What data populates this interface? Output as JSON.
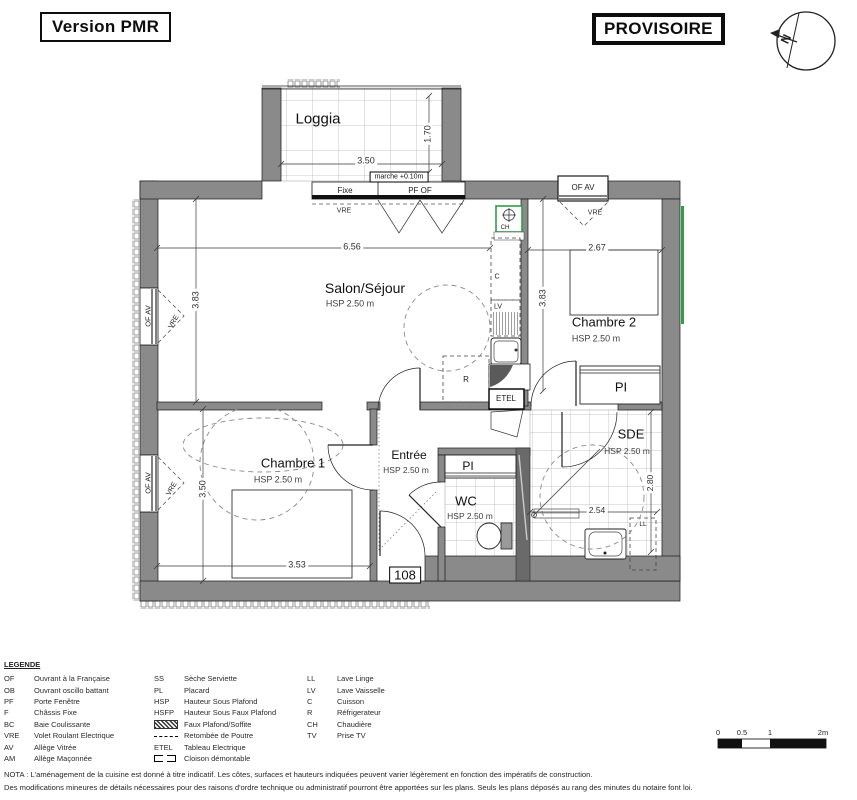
{
  "header": {
    "version_label": "Version PMR",
    "status_label": "PROVISOIRE"
  },
  "colors": {
    "accent_green": "#2f9e44",
    "wall_gray": "#8a8a8a"
  },
  "plan_labels": [
    {
      "name": "room-label-loggia",
      "text": "Loggia",
      "x": 318,
      "y": 119,
      "size": 15,
      "style": "room"
    },
    {
      "name": "dim-loggia-width",
      "text": "3.50",
      "x": 366,
      "y": 161,
      "size": 9,
      "style": "dim"
    },
    {
      "name": "dim-loggia-depth",
      "text": "1.70",
      "x": 428,
      "y": 134,
      "size": 9,
      "rot": -90,
      "style": "dim"
    },
    {
      "name": "label-marche",
      "text": "marche +0.10m",
      "x": 399,
      "y": 177,
      "size": 7,
      "style": "box"
    },
    {
      "name": "label-fixe",
      "text": "Fixe",
      "x": 345,
      "y": 191,
      "size": 8,
      "style": "tiny"
    },
    {
      "name": "label-pf-of",
      "text": "PF OF",
      "x": 420,
      "y": 191,
      "size": 8,
      "style": "tiny"
    },
    {
      "name": "label-vre-loggia",
      "text": "VRE",
      "x": 344,
      "y": 211,
      "size": 7,
      "style": "dim"
    },
    {
      "name": "label-of-av-top",
      "text": "OF AV",
      "x": 583,
      "y": 188,
      "size": 8,
      "style": "tiny"
    },
    {
      "name": "label-vre-top",
      "text": "VRE",
      "x": 595,
      "y": 213,
      "size": 7,
      "style": "dim"
    },
    {
      "name": "room-label-salon",
      "text": "Salon/Séjour",
      "x": 365,
      "y": 288,
      "size": 14,
      "style": "room"
    },
    {
      "name": "label-salon-hsp",
      "text": "HSP 2.50 m",
      "x": 350,
      "y": 304,
      "size": 9,
      "style": "hsp"
    },
    {
      "name": "dim-salon-width",
      "text": "6.56",
      "x": 352,
      "y": 247,
      "size": 9,
      "style": "dim"
    },
    {
      "name": "dim-salon-height",
      "text": "3.83",
      "x": 196,
      "y": 300,
      "size": 9,
      "rot": -90,
      "style": "dim"
    },
    {
      "name": "label-of-av-left-1",
      "text": "OF AV",
      "x": 148,
      "y": 316,
      "size": 7.5,
      "rot": -90,
      "style": "tiny"
    },
    {
      "name": "label-vre-left-1",
      "text": "VRE",
      "x": 174,
      "y": 322,
      "size": 7,
      "rot": -60,
      "style": "tiny"
    },
    {
      "name": "room-label-chambre2",
      "text": "Chambre 2",
      "x": 604,
      "y": 322,
      "size": 13,
      "style": "room"
    },
    {
      "name": "label-chambre2-hsp",
      "text": "HSP 2.50 m",
      "x": 596,
      "y": 339,
      "size": 9,
      "style": "hsp"
    },
    {
      "name": "dim-chambre2-width",
      "text": "2.67",
      "x": 597,
      "y": 248,
      "size": 9,
      "style": "dim"
    },
    {
      "name": "dim-chambre2-height",
      "text": "3.83",
      "x": 543,
      "y": 298,
      "size": 9,
      "rot": -90,
      "style": "dim"
    },
    {
      "name": "label-pi-chambre2",
      "text": "PI",
      "x": 621,
      "y": 387,
      "size": 13,
      "style": "room"
    },
    {
      "name": "room-label-sde",
      "text": "SDE",
      "x": 631,
      "y": 434,
      "size": 13,
      "style": "room"
    },
    {
      "name": "label-sde-hsp",
      "text": "HSP 2.50 m",
      "x": 627,
      "y": 451,
      "size": 8.5,
      "style": "hsp"
    },
    {
      "name": "dim-sde-width",
      "text": "2.54",
      "x": 597,
      "y": 510,
      "size": 8.5,
      "style": "dim"
    },
    {
      "name": "dim-sde-height",
      "text": "2.80",
      "x": 650,
      "y": 483,
      "size": 8.5,
      "rot": -90,
      "style": "dim"
    },
    {
      "name": "label-ll",
      "text": "LL",
      "x": 643,
      "y": 525,
      "size": 6.5,
      "style": "tiny"
    },
    {
      "name": "room-label-chambre1",
      "text": "Chambre 1",
      "x": 293,
      "y": 463,
      "size": 13,
      "style": "room"
    },
    {
      "name": "label-chambre1-hsp",
      "text": "HSP 2.50 m",
      "x": 278,
      "y": 480,
      "size": 9,
      "style": "hsp"
    },
    {
      "name": "dim-chambre1-height",
      "text": "3.50",
      "x": 203,
      "y": 489,
      "size": 9,
      "rot": -90,
      "style": "dim"
    },
    {
      "name": "dim-chambre1-width",
      "text": "3.53",
      "x": 297,
      "y": 565,
      "size": 9,
      "style": "dim"
    },
    {
      "name": "label-of-av-left-2",
      "text": "OF AV",
      "x": 148,
      "y": 483,
      "size": 7.5,
      "rot": -90,
      "style": "tiny"
    },
    {
      "name": "label-vre-left-2",
      "text": "VRE",
      "x": 172,
      "y": 489,
      "size": 7,
      "rot": -60,
      "style": "tiny"
    },
    {
      "name": "room-label-entree",
      "text": "Entrée",
      "x": 409,
      "y": 455,
      "size": 12,
      "style": "room"
    },
    {
      "name": "label-entree-hsp",
      "text": "HSP 2.50 m",
      "x": 406,
      "y": 470,
      "size": 8.5,
      "style": "hsp"
    },
    {
      "name": "label-pi-wc",
      "text": "PI",
      "x": 468,
      "y": 466,
      "size": 12,
      "style": "room"
    },
    {
      "name": "room-label-wc",
      "text": "WC",
      "x": 466,
      "y": 501,
      "size": 13,
      "style": "room"
    },
    {
      "name": "label-wc-hsp",
      "text": "HSP 2.50 m",
      "x": 470,
      "y": 516,
      "size": 8.5,
      "style": "hsp"
    },
    {
      "name": "label-etel",
      "text": "ETEL",
      "x": 506,
      "y": 399,
      "size": 8,
      "style": "tiny"
    },
    {
      "name": "label-ch",
      "text": "CH",
      "x": 505,
      "y": 228,
      "size": 6,
      "style": "tiny"
    },
    {
      "name": "label-c",
      "text": "C",
      "x": 497,
      "y": 277,
      "size": 7,
      "style": "tiny"
    },
    {
      "name": "label-lv",
      "text": "LV",
      "x": 498,
      "y": 307,
      "size": 7,
      "style": "tiny"
    },
    {
      "name": "label-r",
      "text": "R",
      "x": 466,
      "y": 380,
      "size": 8,
      "style": "tiny"
    },
    {
      "name": "apartment-number",
      "text": "108",
      "x": 405,
      "y": 575,
      "size": 13,
      "style": "box"
    },
    {
      "name": "compass-north-label",
      "text": "N",
      "x": 786,
      "y": 39,
      "size": 12,
      "rot": -65,
      "bold": true,
      "style": "tiny"
    }
  ],
  "legend": {
    "title": "LEGENDE",
    "columns": [
      [
        {
          "abbr": "OF",
          "label": "Ouvrant à la Française"
        },
        {
          "abbr": "OB",
          "label": "Ouvrant oscillo battant"
        },
        {
          "abbr": "PF",
          "label": "Porte Fenêtre"
        },
        {
          "abbr": "F",
          "label": "Châssis Fixe"
        },
        {
          "abbr": "BC",
          "label": "Baie Coulissante"
        },
        {
          "abbr": "VRE",
          "label": "Volet Roulant Electrique"
        },
        {
          "abbr": "AV",
          "label": "Allège Vitrée"
        },
        {
          "abbr": "AM",
          "label": "Allège Maçonnée"
        }
      ],
      [
        {
          "abbr": "SS",
          "label": "Sèche Serviette"
        },
        {
          "abbr": "PL",
          "label": "Placard"
        },
        {
          "abbr": "HSP",
          "label": "Hauteur Sous Plafond"
        },
        {
          "abbr": "HSFP",
          "label": "Hauteur Sous Faux Plafond"
        },
        {
          "icon": "hatch",
          "label": "Faux Plafond/Soffite"
        },
        {
          "icon": "beam",
          "label": "Retombée de Poutre"
        },
        {
          "abbr": "ETEL",
          "label": "Tableau Electrique"
        },
        {
          "icon": "partition",
          "label": "Cloison démontable"
        }
      ],
      [
        {
          "abbr": "LL",
          "label": "Lave Linge"
        },
        {
          "abbr": "LV",
          "label": "Lave Vaisselle"
        },
        {
          "abbr": "C",
          "label": "Cuisson"
        },
        {
          "abbr": "R",
          "label": "Réfrigerateur"
        },
        {
          "abbr": "CH",
          "label": "Chaudière"
        },
        {
          "abbr": "TV",
          "label": "Prise TV"
        }
      ]
    ]
  },
  "scale_bar": {
    "ticks": [
      {
        "label": "0",
        "x": 718
      },
      {
        "label": "0.5",
        "x": 742
      },
      {
        "label": "1",
        "x": 770
      },
      {
        "label": "2m",
        "x": 823
      }
    ]
  },
  "nota": {
    "line1": "NOTA : L'aménagement de la cuisine est donné à titre indicatif. Les côtes, surfaces et hauteurs indiquées peuvent varier légèrement en fonction des impératifs de construction.",
    "line2": "Des modifications mineures de détails nécessaires pour des raisons d'ordre technique ou administratif pourront être apportées sur les plans. Seuls les plans déposés au rang des minutes du notaire font loi."
  }
}
